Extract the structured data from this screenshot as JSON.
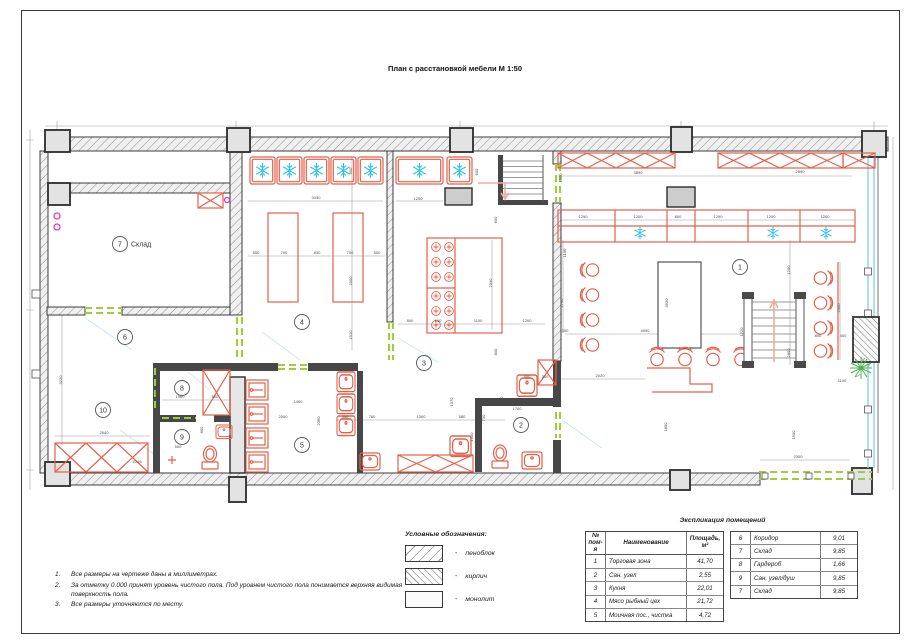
{
  "title": "План с расстановкой мебели М 1:50",
  "colors": {
    "furniture_red": "#e4604a",
    "freezer_cyan": "#2fc4ea",
    "opening_green": "#9ecf3a",
    "window_blue": "#8ed2ea",
    "door_magenta": "#e23ec1",
    "wall_dark": "#3c3c3c",
    "dimension_gray": "#4a4a4a",
    "leader_blue": "#c4e4f1",
    "plant_green": "#4caf50"
  },
  "legend": {
    "title": "Условные обозначения:",
    "dash": "-",
    "items": [
      {
        "name": "пеноблок",
        "pattern": "foam"
      },
      {
        "name": "кирпич",
        "pattern": "brick"
      },
      {
        "name": "монолит",
        "pattern": "solid"
      }
    ]
  },
  "notes": {
    "items": [
      "Все размеры на чертеже даны в миллиметрах.",
      "За отметку 0.000 принят уровень чистого пола. Под уровнем чистого пола понимается верхняя видимая поверхность пола.",
      "Все размеры уточняются по месту."
    ]
  },
  "schedule": {
    "title": "Экспликация помещений",
    "headers": {
      "num": "№ пом-я",
      "name": "Наименование",
      "area": "Площадь, м²"
    },
    "left_rows": [
      [
        "1",
        "Торговая зона",
        "41,70"
      ],
      [
        "2",
        "Сан. узел",
        "2,55"
      ],
      [
        "3",
        "Кухня",
        "22,01"
      ],
      [
        "4",
        "Мясо рыбный цех",
        "21,72"
      ],
      [
        "5",
        "Моичная пос., чистка",
        "4,72"
      ]
    ],
    "right_rows": [
      [
        "6",
        "Коридор",
        "9,01"
      ],
      [
        "7",
        "Склад",
        "9,85"
      ],
      [
        "8",
        "Гардероб",
        "1,66"
      ],
      [
        "9",
        "Сан. узел/душ",
        "9,85"
      ],
      [
        "7",
        "Склад",
        "9,85"
      ]
    ]
  },
  "plan": {
    "rooms": [
      {
        "num": "7",
        "label": "Склад",
        "x": 120,
        "y": 244
      },
      {
        "num": "6",
        "x": 125,
        "y": 337
      },
      {
        "num": "10",
        "x": 103,
        "y": 410
      },
      {
        "num": "8",
        "x": 182,
        "y": 388
      },
      {
        "num": "9",
        "x": 182,
        "y": 437
      },
      {
        "num": "4",
        "x": 302,
        "y": 322
      },
      {
        "num": "5",
        "x": 302,
        "y": 445
      },
      {
        "num": "3",
        "x": 424,
        "y": 363
      },
      {
        "num": "2",
        "x": 521,
        "y": 425
      },
      {
        "num": "1",
        "x": 740,
        "y": 267
      }
    ],
    "dimensions": [
      {
        "x": 316,
        "y": 199,
        "t": "3330"
      },
      {
        "x": 418,
        "y": 200,
        "t": "1200"
      },
      {
        "x": 352,
        "y": 171,
        "t": "600",
        "r": 1
      },
      {
        "x": 478,
        "y": 172,
        "t": "600",
        "r": 1
      },
      {
        "x": 256,
        "y": 254,
        "t": "550"
      },
      {
        "x": 284,
        "y": 254,
        "t": "700"
      },
      {
        "x": 317,
        "y": 254,
        "t": "830"
      },
      {
        "x": 350,
        "y": 254,
        "t": "700"
      },
      {
        "x": 377,
        "y": 254,
        "t": "500"
      },
      {
        "x": 352,
        "y": 281,
        "t": "2000",
        "r": 1
      },
      {
        "x": 352,
        "y": 335,
        "t": "1510",
        "r": 1
      },
      {
        "x": 410,
        "y": 322,
        "t": "800"
      },
      {
        "x": 438,
        "y": 322,
        "t": "600"
      },
      {
        "x": 478,
        "y": 322,
        "t": "1100"
      },
      {
        "x": 527,
        "y": 322,
        "t": "1200"
      },
      {
        "x": 497,
        "y": 220,
        "t": "600",
        "r": 1
      },
      {
        "x": 492,
        "y": 283,
        "t": "2330",
        "r": 1
      },
      {
        "x": 497,
        "y": 352,
        "t": "800",
        "r": 1
      },
      {
        "x": 62,
        "y": 380,
        "t": "3220",
        "r": 1
      },
      {
        "x": 104,
        "y": 434,
        "t": "2540"
      },
      {
        "x": 137,
        "y": 463,
        "t": "10.91"
      },
      {
        "x": 158,
        "y": 393,
        "t": "1000",
        "r": 1
      },
      {
        "x": 180,
        "y": 398,
        "t": "1060"
      },
      {
        "x": 215,
        "y": 398,
        "t": "600"
      },
      {
        "x": 158,
        "y": 437,
        "t": "1230",
        "r": 1
      },
      {
        "x": 178,
        "y": 448,
        "t": "500"
      },
      {
        "x": 283,
        "y": 418,
        "t": "2000"
      },
      {
        "x": 298,
        "y": 403,
        "t": "1400"
      },
      {
        "x": 320,
        "y": 421,
        "t": "2360",
        "r": 1
      },
      {
        "x": 203,
        "y": 430,
        "t": "800",
        "r": 1
      },
      {
        "x": 345,
        "y": 418,
        "t": "450"
      },
      {
        "x": 372,
        "y": 418,
        "t": "760"
      },
      {
        "x": 421,
        "y": 418,
        "t": "1300"
      },
      {
        "x": 462,
        "y": 418,
        "t": "580"
      },
      {
        "x": 362,
        "y": 405,
        "t": "2010",
        "r": 1
      },
      {
        "x": 453,
        "y": 402,
        "t": "1070",
        "r": 1
      },
      {
        "x": 503,
        "y": 400,
        "t": "770",
        "r": 1
      },
      {
        "x": 517,
        "y": 410,
        "t": "1700"
      },
      {
        "x": 600,
        "y": 377,
        "t": "2020"
      },
      {
        "x": 473,
        "y": 437,
        "t": "1500",
        "r": 1
      },
      {
        "x": 485,
        "y": 418,
        "t": "730",
        "r": 1
      },
      {
        "x": 527,
        "y": 378,
        "t": "550"
      },
      {
        "x": 545,
        "y": 378,
        "t": "300"
      },
      {
        "x": 638,
        "y": 174,
        "t": "3890"
      },
      {
        "x": 800,
        "y": 173,
        "t": "2890"
      },
      {
        "x": 583,
        "y": 218,
        "t": "1290"
      },
      {
        "x": 638,
        "y": 218,
        "t": "1200"
      },
      {
        "x": 678,
        "y": 218,
        "t": "800"
      },
      {
        "x": 718,
        "y": 218,
        "t": "1290"
      },
      {
        "x": 771,
        "y": 218,
        "t": "1200"
      },
      {
        "x": 825,
        "y": 218,
        "t": "1200"
      },
      {
        "x": 562,
        "y": 178,
        "t": "1300",
        "r": 1
      },
      {
        "x": 566,
        "y": 253,
        "t": "1100",
        "r": 1
      },
      {
        "x": 563,
        "y": 303,
        "t": "2700",
        "r": 1
      },
      {
        "x": 565,
        "y": 332,
        "t": "300"
      },
      {
        "x": 645,
        "y": 332,
        "t": "4090"
      },
      {
        "x": 668,
        "y": 303,
        "t": "3520",
        "r": 1
      },
      {
        "x": 790,
        "y": 270,
        "t": "1200",
        "r": 1
      },
      {
        "x": 743,
        "y": 332,
        "t": "1720",
        "r": 1
      },
      {
        "x": 790,
        "y": 353,
        "t": "2800",
        "r": 1
      },
      {
        "x": 818,
        "y": 337,
        "t": "800"
      },
      {
        "x": 843,
        "y": 337,
        "t": "400"
      },
      {
        "x": 840,
        "y": 308,
        "t": "2300",
        "r": 1
      },
      {
        "x": 842,
        "y": 382,
        "t": "1100"
      },
      {
        "x": 795,
        "y": 435,
        "t": "1500",
        "r": 1
      },
      {
        "x": 798,
        "y": 458,
        "t": "2300"
      },
      {
        "x": 667,
        "y": 427,
        "t": "1800",
        "r": 1
      }
    ]
  }
}
